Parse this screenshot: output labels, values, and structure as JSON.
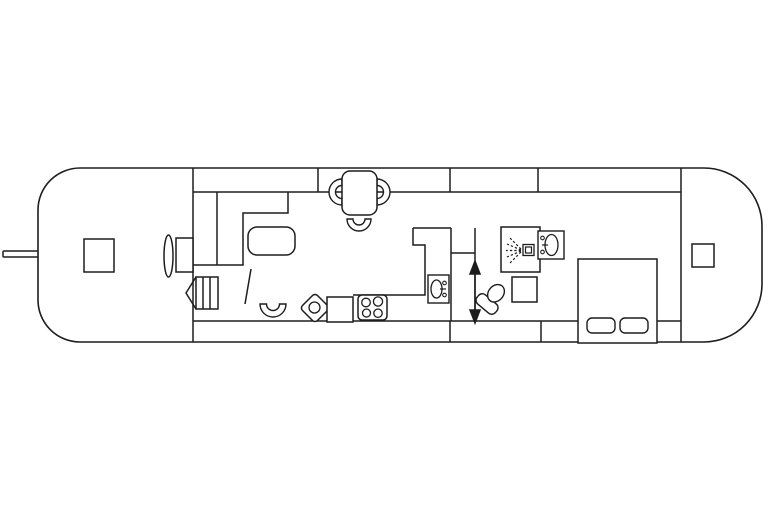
{
  "canvas": {
    "width": 768,
    "height": 512
  },
  "floorplan": {
    "title": "",
    "line_color": "#1d1d1d",
    "background_color": "#ffffff",
    "fill_color": "#ffffff",
    "stroke_width": 1.5,
    "shapes": [
      {
        "name": "tiller-bar",
        "kind": "rect",
        "x": 3,
        "y": 251,
        "w": 37,
        "h": 6,
        "rx": 1
      },
      {
        "name": "hull-outline",
        "kind": "hull",
        "x": 38,
        "y": 168,
        "w": 724,
        "h": 174,
        "rl": 42,
        "rr": 58,
        "sw": 1.6
      },
      {
        "name": "gunwale-line-top",
        "kind": "line",
        "x1": 193,
        "y1": 192,
        "x2": 681,
        "y2": 192
      },
      {
        "name": "gunwale-line-bottom",
        "kind": "line",
        "x1": 193,
        "y1": 321,
        "x2": 681,
        "y2": 321
      },
      {
        "name": "bow-bulkhead-wall",
        "kind": "line",
        "x1": 193,
        "y1": 168,
        "x2": 193,
        "y2": 342
      },
      {
        "name": "stern-bulkhead-wall",
        "kind": "line",
        "x1": 681,
        "y1": 168,
        "x2": 681,
        "y2": 342
      },
      {
        "name": "top-band-tick-1",
        "kind": "line",
        "x1": 318,
        "y1": 168,
        "x2": 318,
        "y2": 192
      },
      {
        "name": "top-band-tick-2",
        "kind": "line",
        "x1": 450,
        "y1": 168,
        "x2": 450,
        "y2": 192
      },
      {
        "name": "top-band-tick-3",
        "kind": "line",
        "x1": 538,
        "y1": 168,
        "x2": 538,
        "y2": 192
      },
      {
        "name": "bottom-band-tick-1",
        "kind": "line",
        "x1": 450,
        "y1": 321,
        "x2": 450,
        "y2": 342
      },
      {
        "name": "bottom-band-tick-2",
        "kind": "line",
        "x1": 541,
        "y1": 321,
        "x2": 541,
        "y2": 342
      },
      {
        "name": "closet-divider-wall",
        "kind": "line",
        "x1": 217,
        "y1": 192,
        "x2": 217,
        "y2": 265
      },
      {
        "name": "closet-wall",
        "kind": "polyline",
        "pts": [
          [
            288,
            192
          ],
          [
            288,
            213
          ],
          [
            243,
            213
          ],
          [
            243,
            265
          ],
          [
            192,
            265
          ]
        ]
      },
      {
        "name": "wc-room-top-wall",
        "kind": "line",
        "x1": 413,
        "y1": 228,
        "x2": 451,
        "y2": 228
      },
      {
        "name": "wc-room-wall-and-counter",
        "kind": "polyline",
        "pts": [
          [
            413,
            228
          ],
          [
            413,
            245
          ],
          [
            425,
            245
          ],
          [
            425,
            295
          ],
          [
            353,
            295
          ]
        ]
      },
      {
        "name": "corridor-wall-left",
        "kind": "line",
        "x1": 451,
        "y1": 228,
        "x2": 451,
        "y2": 321
      },
      {
        "name": "corridor-wall-right",
        "kind": "line",
        "x1": 475,
        "y1": 228,
        "x2": 475,
        "y2": 321
      },
      {
        "name": "corridor-shelf-line",
        "kind": "line",
        "x1": 451,
        "y1": 253,
        "x2": 475,
        "y2": 253
      },
      {
        "name": "bow-deck-hatch",
        "kind": "rect",
        "x": 84,
        "y": 239,
        "w": 30,
        "h": 33
      },
      {
        "name": "bow-door-ellipse",
        "kind": "ellipse",
        "cx": 168.5,
        "cy": 256,
        "rx": 4.5,
        "ry": 21
      },
      {
        "name": "bow-step-box",
        "kind": "rect",
        "x": 176,
        "y": 238,
        "w": 17,
        "h": 34
      },
      {
        "name": "stairs-box",
        "kind": "rect",
        "x": 196,
        "y": 277,
        "w": 22,
        "h": 32
      },
      {
        "name": "stairs-tread-1",
        "kind": "line",
        "x1": 203,
        "y1": 277,
        "x2": 203,
        "y2": 309
      },
      {
        "name": "stairs-tread-2",
        "kind": "line",
        "x1": 210,
        "y1": 277,
        "x2": 210,
        "y2": 309
      },
      {
        "name": "stairs-direction-arrow",
        "kind": "polyline",
        "pts": [
          [
            196,
            277
          ],
          [
            186,
            293
          ],
          [
            196,
            309
          ]
        ]
      },
      {
        "name": "coffee-table",
        "kind": "rect",
        "x": 248,
        "y": 227,
        "w": 47,
        "h": 28,
        "rx": 9
      },
      {
        "name": "saloon-door-leaf",
        "kind": "line",
        "x1": 251,
        "y1": 269,
        "x2": 245,
        "y2": 304
      },
      {
        "name": "saloon-chair",
        "kind": "chair",
        "cx": 273,
        "cy": 304,
        "R": 13,
        "r": 6.5,
        "open": "up",
        "sw": 1.4
      },
      {
        "name": "dining-chair-left",
        "kind": "chair",
        "cx": 342,
        "cy": 192,
        "R": 13,
        "r": 6.5,
        "open": "right",
        "sw": 1.4
      },
      {
        "name": "dining-chair-right",
        "kind": "chair",
        "cx": 377,
        "cy": 192,
        "R": 13,
        "r": 6.5,
        "open": "left",
        "sw": 1.4
      },
      {
        "name": "dining-table",
        "kind": "rect",
        "x": 342,
        "y": 171,
        "w": 35,
        "h": 44,
        "rx": 8
      },
      {
        "name": "dining-chair-bottom",
        "kind": "chair",
        "cx": 359,
        "cy": 219,
        "R": 12,
        "r": 6,
        "open": "up",
        "sw": 1.4
      },
      {
        "name": "galley-diamond-unit",
        "kind": "rect",
        "x": 304.4,
        "y": 297.4,
        "w": 21.2,
        "h": 21.2,
        "rx": 3.5,
        "rotate": 45,
        "ox": 315,
        "oy": 308
      },
      {
        "name": "galley-diamond-knob",
        "kind": "circle",
        "cx": 314.5,
        "cy": 307.5,
        "r": 5.5,
        "sw": 1.3
      },
      {
        "name": "galley-square-unit",
        "kind": "rect",
        "x": 327,
        "y": 297,
        "w": 26,
        "h": 25
      },
      {
        "name": "stove",
        "kind": "rect",
        "x": 358,
        "y": 295,
        "w": 29,
        "h": 25,
        "rx": 4
      },
      {
        "name": "stove-burner-1",
        "kind": "circle",
        "cx": 366,
        "cy": 302.5,
        "r": 4.3,
        "sw": 1.3
      },
      {
        "name": "stove-burner-2",
        "kind": "circle",
        "cx": 378,
        "cy": 301.5,
        "r": 4.6,
        "sw": 1.3
      },
      {
        "name": "stove-burner-3",
        "kind": "circle",
        "cx": 366.5,
        "cy": 313,
        "r": 4.0,
        "sw": 1.3
      },
      {
        "name": "stove-burner-4",
        "kind": "circle",
        "cx": 378,
        "cy": 313.2,
        "r": 4.2,
        "sw": 1.3
      },
      {
        "name": "washbasin-icon",
        "kind": "rect",
        "x": 428,
        "y": 275,
        "w": 21,
        "h": 28,
        "sw": 1.4
      },
      {
        "name": "washbasin-bowl",
        "kind": "ellipse",
        "cx": 436.5,
        "cy": 289,
        "rx": 5.5,
        "ry": 9,
        "sw": 1.3
      },
      {
        "name": "washbasin-tap-1",
        "kind": "circle",
        "cx": 444.5,
        "cy": 283,
        "r": 1.8,
        "sw": 1.1
      },
      {
        "name": "washbasin-tap-2",
        "kind": "circle",
        "cx": 444.5,
        "cy": 295,
        "r": 1.8,
        "sw": 1.1
      },
      {
        "name": "washbasin-spout",
        "kind": "line",
        "x1": 440,
        "y1": 289,
        "x2": 446,
        "y2": 289,
        "sw": 1.2
      },
      {
        "name": "passage-arrow-shaft",
        "kind": "line",
        "x1": 475,
        "y1": 267,
        "x2": 475,
        "y2": 317
      },
      {
        "name": "passage-arrow-head-up",
        "kind": "polygon",
        "pts": [
          [
            475,
            261
          ],
          [
            470,
            274
          ],
          [
            480,
            274
          ]
        ],
        "black": true
      },
      {
        "name": "passage-arrow-head-down",
        "kind": "polygon",
        "pts": [
          [
            475,
            323
          ],
          [
            470,
            310
          ],
          [
            480,
            310
          ]
        ],
        "black": true
      },
      {
        "name": "shower-cubicle",
        "kind": "rect",
        "x": 501,
        "y": 227,
        "w": 39,
        "h": 45
      },
      {
        "name": "shower-spray-1",
        "kind": "dline",
        "x1": 521,
        "y1": 249,
        "x2": 510,
        "y2": 238,
        "sw": 1.2
      },
      {
        "name": "shower-spray-2",
        "kind": "dline",
        "x1": 521,
        "y1": 250,
        "x2": 507,
        "y2": 244,
        "sw": 1.2
      },
      {
        "name": "shower-spray-3",
        "kind": "dline",
        "x1": 521,
        "y1": 250.5,
        "x2": 506,
        "y2": 250.5,
        "sw": 1.2
      },
      {
        "name": "shower-spray-4",
        "kind": "dline",
        "x1": 521,
        "y1": 251,
        "x2": 507,
        "y2": 257,
        "sw": 1.2
      },
      {
        "name": "shower-spray-5",
        "kind": "dline",
        "x1": 521,
        "y1": 252,
        "x2": 510,
        "y2": 263,
        "sw": 1.2
      },
      {
        "name": "shower-head-icon",
        "kind": "rect",
        "x": 523,
        "y": 244.5,
        "w": 11,
        "h": 11,
        "sw": 1.3
      },
      {
        "name": "shower-head-inner",
        "kind": "rect",
        "x": 525.5,
        "y": 247,
        "w": 6,
        "h": 6,
        "sw": 1.2
      },
      {
        "name": "bathroom-cabinet",
        "kind": "rect",
        "x": 512,
        "y": 277,
        "w": 25,
        "h": 25
      },
      {
        "name": "toilet-base",
        "kind": "rect",
        "x": 475,
        "y": 298,
        "w": 24,
        "h": 12,
        "rx": 5,
        "rotate": 40,
        "ox": 487,
        "oy": 304,
        "sw": 1.4
      },
      {
        "name": "toilet-bowl",
        "kind": "ellipse",
        "cx": 487,
        "cy": 290,
        "rx": 7.5,
        "ry": 9.5,
        "rotate": 40,
        "ox": 487,
        "oy": 304,
        "sw": 1.4
      },
      {
        "name": "bedroom-washbasin-icon",
        "kind": "rect",
        "x": 538,
        "y": 231,
        "w": 26,
        "h": 28,
        "sw": 1.4
      },
      {
        "name": "bedroom-washbasin-bowl",
        "kind": "ellipse",
        "cx": 551.5,
        "cy": 245,
        "rx": 6.5,
        "ry": 10.5,
        "sw": 1.3
      },
      {
        "name": "bedroom-washbasin-tap-1",
        "kind": "circle",
        "cx": 542.5,
        "cy": 238,
        "r": 1.8,
        "sw": 1.1
      },
      {
        "name": "bedroom-washbasin-tap-2",
        "kind": "circle",
        "cx": 542.5,
        "cy": 252,
        "r": 1.8,
        "sw": 1.1
      },
      {
        "name": "bedroom-washbasin-spout",
        "kind": "line",
        "x1": 542,
        "y1": 245,
        "x2": 548,
        "y2": 245,
        "sw": 1.2
      },
      {
        "name": "bed",
        "kind": "rect",
        "x": 578,
        "y": 259,
        "w": 79,
        "h": 84
      },
      {
        "name": "bed-pillow-1",
        "kind": "rect",
        "x": 587,
        "y": 318,
        "w": 28,
        "h": 15,
        "rx": 5,
        "sw": 1.4
      },
      {
        "name": "bed-pillow-2",
        "kind": "rect",
        "x": 620,
        "y": 318,
        "w": 28,
        "h": 15,
        "rx": 5,
        "sw": 1.4
      },
      {
        "name": "stern-deck-hatch",
        "kind": "rect",
        "x": 692,
        "y": 244,
        "w": 22,
        "h": 23
      }
    ]
  }
}
